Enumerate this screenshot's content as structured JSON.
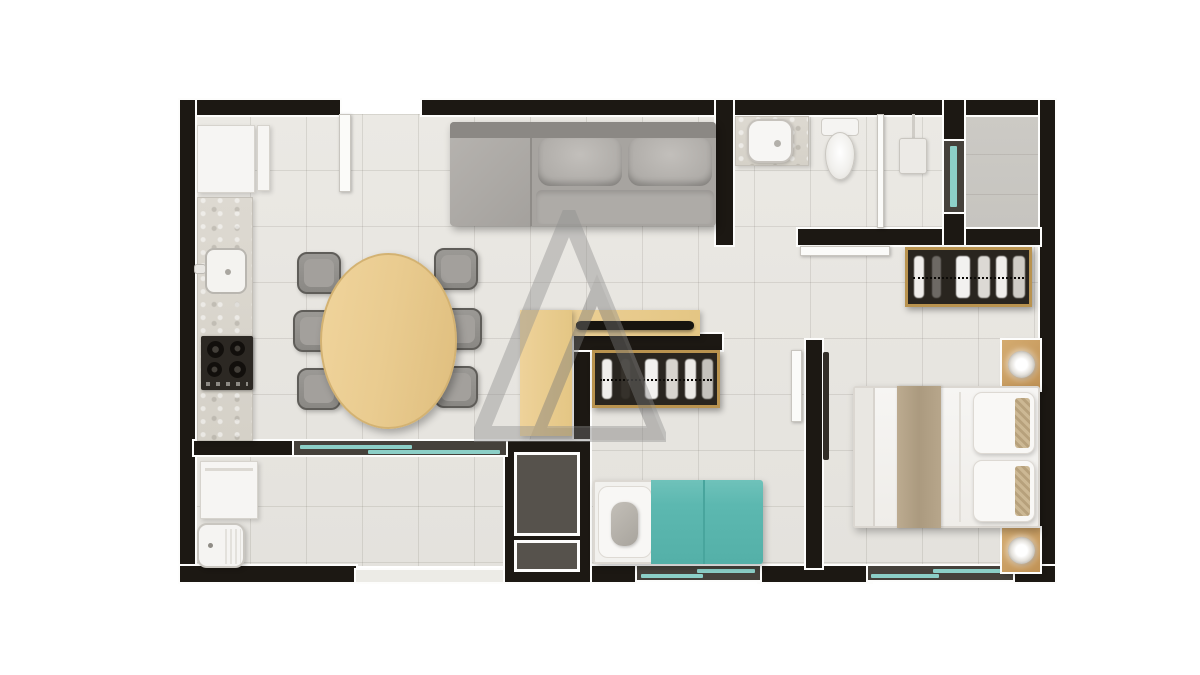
{
  "scene": {
    "type": "apartment floor plan, top-down 3D render",
    "background_color": "#ffffff",
    "watermark": {
      "name": "double-triangle A logo",
      "color": "#8d8d8d",
      "opacity": 0.42
    }
  },
  "palette": {
    "wall": "#1c1813",
    "floor_tile": "#e9e7e2",
    "utility_floor": "#c9c7c2",
    "window_glass": "#8ccfc7",
    "window_frame": "#45413b",
    "light_wood": "#eccf94",
    "rack_frame": "#b9934f",
    "sofa_gray": "#a7a4a0",
    "teal_bedding": "#5cb8b0",
    "white_fixtures": "#f6f5f3"
  },
  "rooms": {
    "kitchen": "Kitchen",
    "dining": "Dining area",
    "living": "Living room",
    "hall": "Hallway",
    "bathroom": "Bathroom",
    "utility": "Utility room",
    "master_bedroom": "Master bedroom",
    "second_bedroom": "Second bedroom",
    "service": "Laundry service area",
    "shaft": "Technical shaft"
  },
  "furniture": {
    "refrigerator": "Refrigerator",
    "kitchen_cabinet": "Kitchen cabinet",
    "kitchen_counter": "Kitchen counter",
    "kitchen_sink": "Kitchen sink",
    "cooktop": "4-burner cooktop",
    "dining_table": "Oval wooden dining table",
    "dining_chair": "Dining chair",
    "sofa": "Gray sofa",
    "chaise": "Chaise section",
    "sofa_cushion": "Sofa cushion",
    "tv_sideboard": "Wooden TV sideboard",
    "tv": "Flat TV",
    "entrance_door": "Entrance door",
    "bathroom_vanity": "Bathroom vanity counter",
    "bathroom_sink": "Bathroom sink",
    "toilet": "Toilet",
    "shower": "Shower",
    "shower_screen": "Shower partition",
    "bathroom_sliding_door": "Bathroom sliding door",
    "clothes_rack_master": "Open clothes rack with hangers",
    "clothes_rack_second": "Open clothes rack with hangers",
    "double_bed": "Double bed with runner",
    "bed_runner": "Beige bed runner",
    "pillow": "Pillow",
    "nightstand": "Nightstand with lamp",
    "single_bed": "Single bed with teal bedding",
    "bolster": "Bolster pillow",
    "washing_machine": "Washing machine",
    "laundry_tank": "Laundry tank sink",
    "second_bedroom_door": "Second bedroom door",
    "master_bedroom_door": "Master bedroom door",
    "shaft_hatch": "Shaft hatch",
    "window_dining_service": "Long sliding window between dining and service area",
    "window_second_bedroom": "Second bedroom sliding window",
    "window_master_bedroom": "Master bedroom sliding window",
    "window_utility": "Utility room window"
  }
}
